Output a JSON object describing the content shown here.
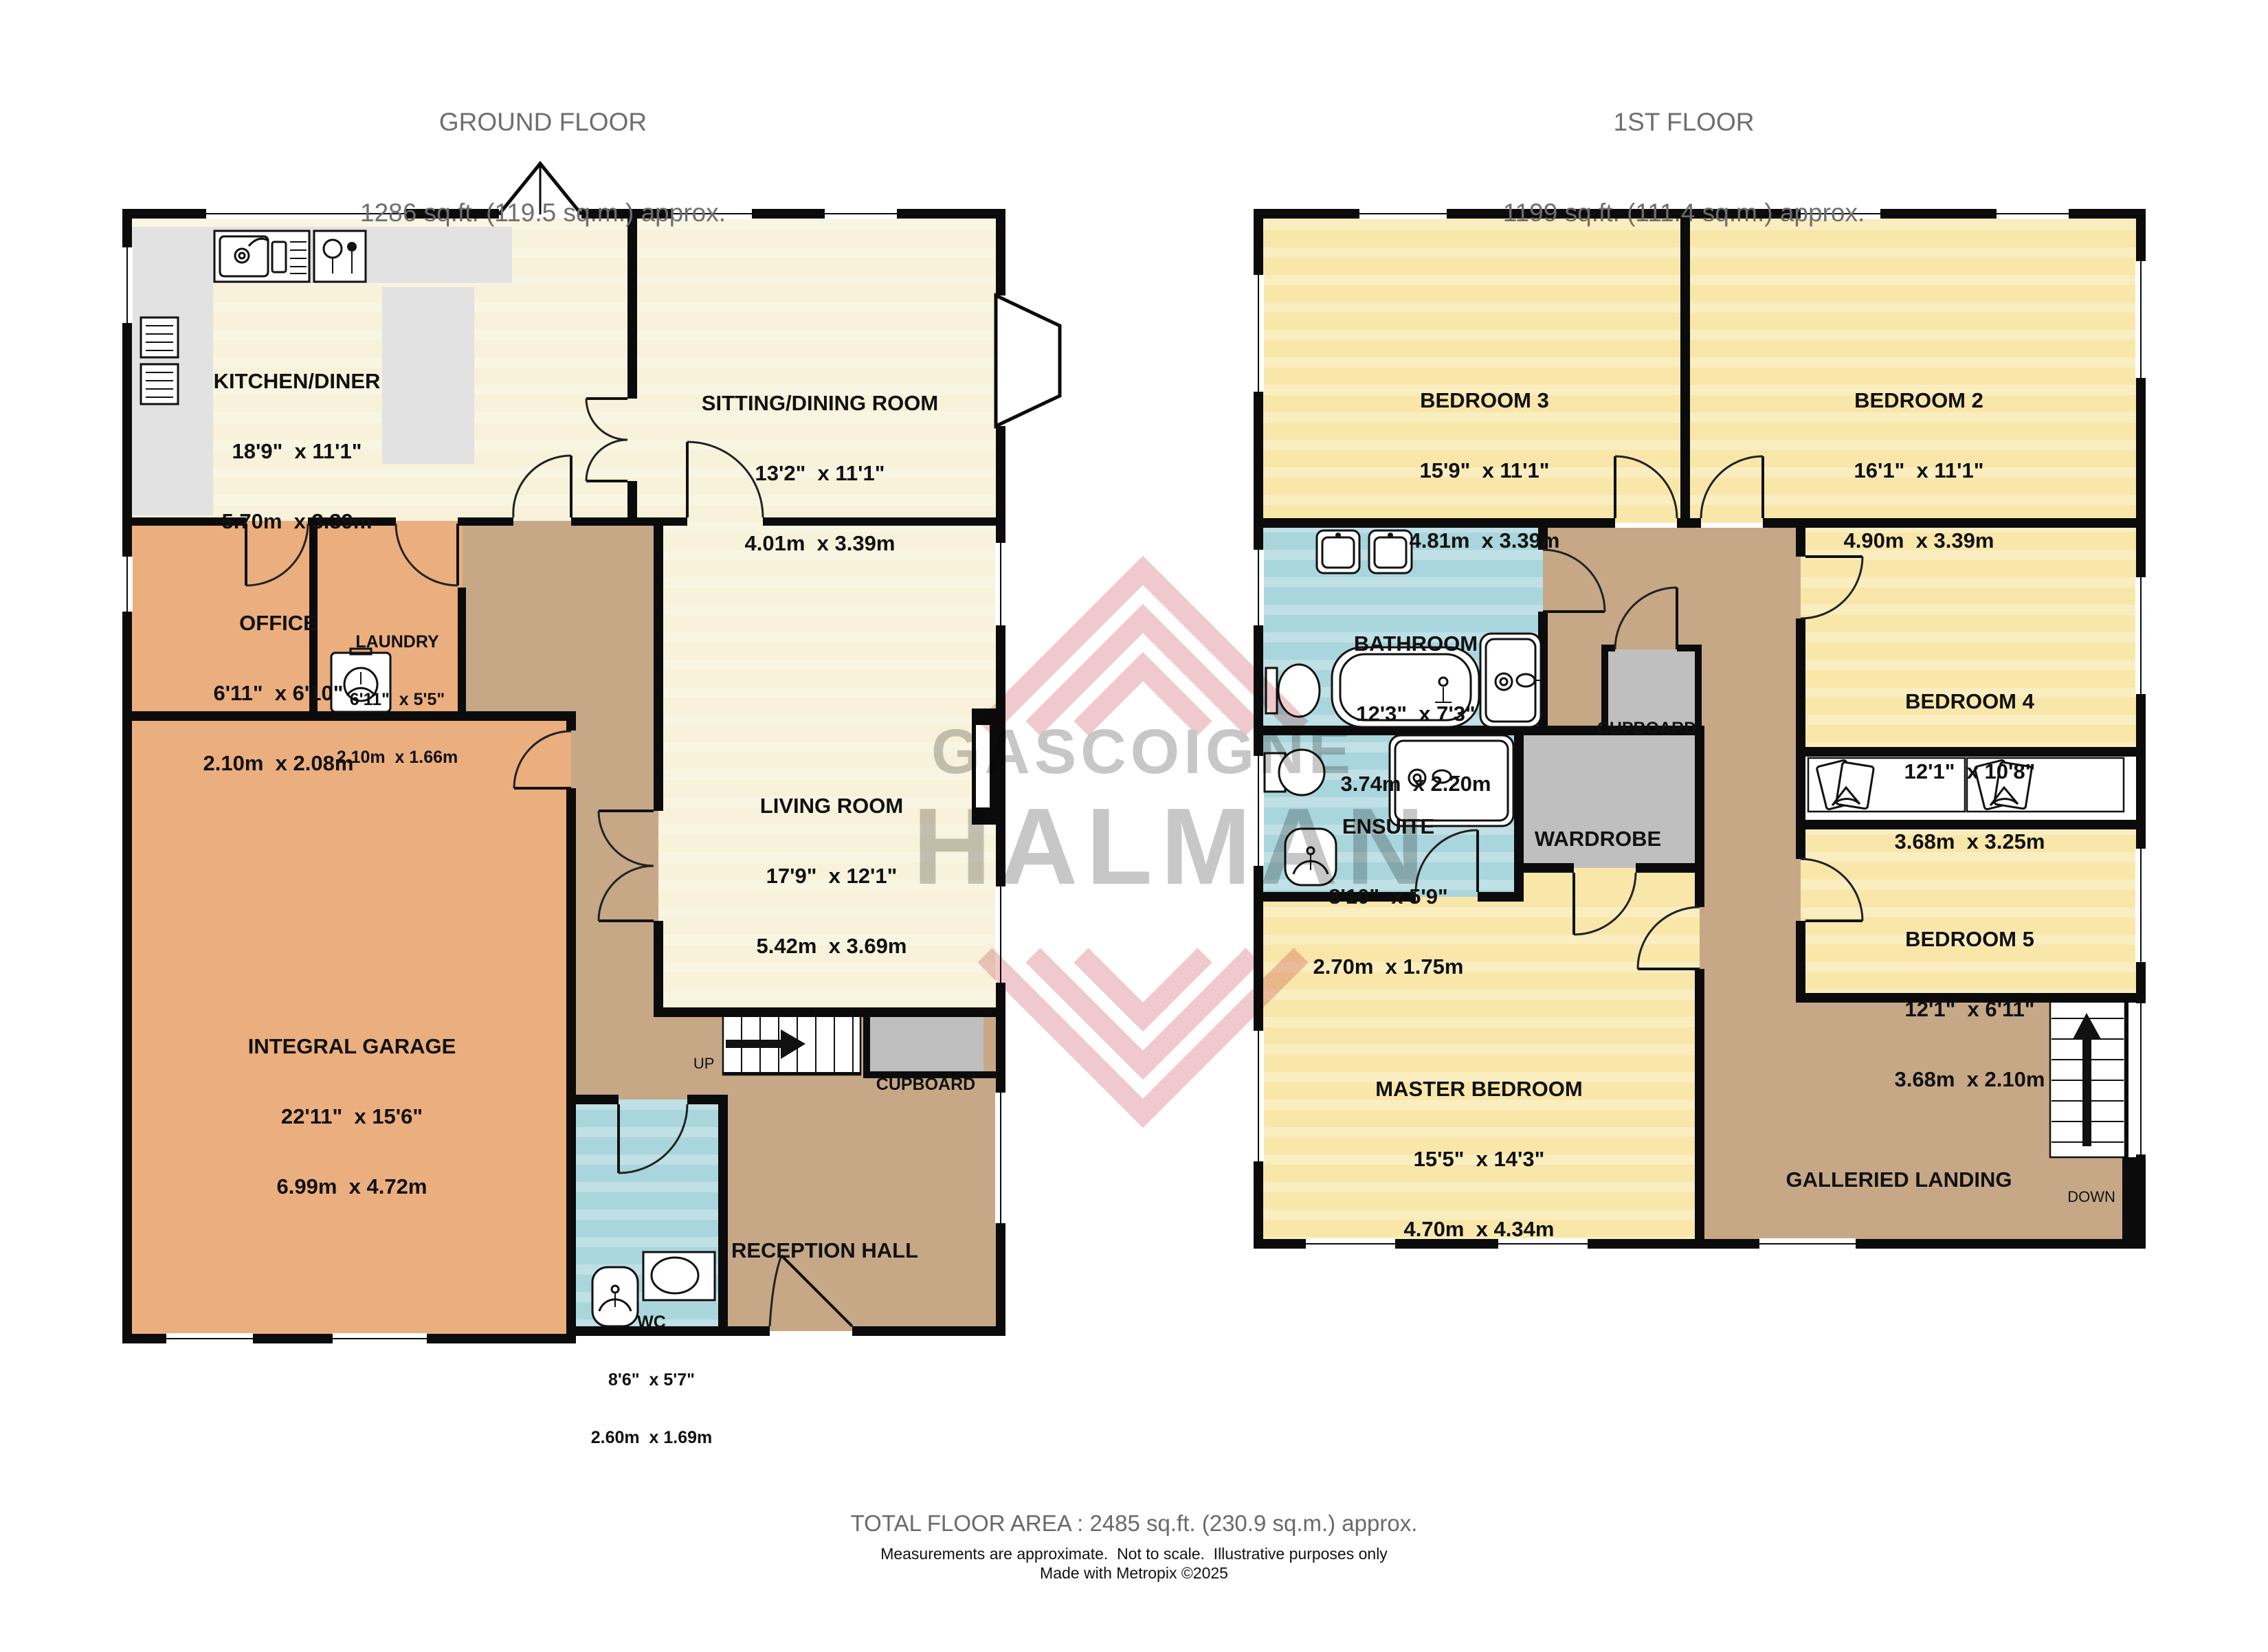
{
  "header": {
    "ground_title": "GROUND FLOOR",
    "ground_area": "1286 sq.ft. (119.5 sq.m.) approx.",
    "first_title": "1ST FLOOR",
    "first_area": "1199 sq.ft. (111.4 sq.m.) approx."
  },
  "rooms": {
    "kitchen_diner": {
      "name": "KITCHEN/DINER",
      "imperial": "18'9\"  x 11'1\"",
      "metric": "5.70m  x 3.39m"
    },
    "sitting_dining": {
      "name": "SITTING/DINING ROOM",
      "imperial": "13'2\"  x 11'1\"",
      "metric": "4.01m  x 3.39m"
    },
    "office": {
      "name": "OFFICE",
      "imperial": "6'11\"  x 6'10\"",
      "metric": "2.10m  x 2.08m"
    },
    "laundry": {
      "name": "LAUNDRY",
      "imperial": "6'11\"  x 5'5\"",
      "metric": "2.10m  x 1.66m"
    },
    "living_room": {
      "name": "LIVING ROOM",
      "imperial": "17'9\"  x 12'1\"",
      "metric": "5.42m  x 3.69m"
    },
    "integral_garage": {
      "name": "INTEGRAL GARAGE",
      "imperial": "22'11\"  x 15'6\"",
      "metric": "6.99m  x 4.72m"
    },
    "wc": {
      "name": "WC",
      "imperial": "8'6\"  x 5'7\"",
      "metric": "2.60m  x 1.69m"
    },
    "reception_hall": {
      "name": "RECEPTION HALL"
    },
    "cupboard_ground": {
      "name": "CUPBOARD"
    },
    "bedroom_3": {
      "name": "BEDROOM 3",
      "imperial": "15'9\"  x 11'1\"",
      "metric": "4.81m  x 3.39m"
    },
    "bedroom_2": {
      "name": "BEDROOM 2",
      "imperial": "16'1\"  x 11'1\"",
      "metric": "4.90m  x 3.39m"
    },
    "bathroom": {
      "name": "BATHROOM",
      "imperial": "12'3\"  x 7'3\"",
      "metric": "3.74m  x 2.20m"
    },
    "cupboard_first": {
      "name": "CUPBOARD"
    },
    "ensuite": {
      "name": "ENSUITE",
      "imperial": "8'10\"  x 5'9\"",
      "metric": "2.70m  x 1.75m"
    },
    "wardrobe": {
      "name": "WARDROBE"
    },
    "bedroom_4": {
      "name": "BEDROOM 4",
      "imperial": "12'1\"  x 10'8\"",
      "metric": "3.68m  x 3.25m"
    },
    "bedroom_5": {
      "name": "BEDROOM 5",
      "imperial": "12'1\"  x 6'11\"",
      "metric": "3.68m  x 2.10m"
    },
    "master_bedroom": {
      "name": "MASTER BEDROOM",
      "imperial": "15'5\"  x 14'3\"",
      "metric": "4.70m  x 4.34m"
    },
    "galleried_landing": {
      "name": "GALLERIED LANDING"
    }
  },
  "stairs": {
    "up": "UP",
    "down": "DOWN"
  },
  "watermark": {
    "line1": "GASCOIGNE",
    "line2": "HALMAN"
  },
  "footer": {
    "total": "TOTAL FLOOR AREA : 2485 sq.ft. (230.9 sq.m.) approx.",
    "note1": "Measurements are approximate.  Not to scale.  Illustrative purposes only",
    "note2": "Made with Metropix ©2025"
  },
  "colors": {
    "room_cream": "#F7F2D9",
    "bedroom_yellow": "#F8E7A9",
    "garage_orange": "#EBAE7E",
    "hall_tan": "#C6A887",
    "bath_blue": "#A9D6DC",
    "cupboard_gray": "#BFBFBF",
    "counter_gray": "#E2E2E2",
    "wall_black": "#0b0b0b",
    "header_text": "#6E6E6E",
    "watermark_red": "#D4707B",
    "watermark_gray": "#8f8f8f"
  }
}
